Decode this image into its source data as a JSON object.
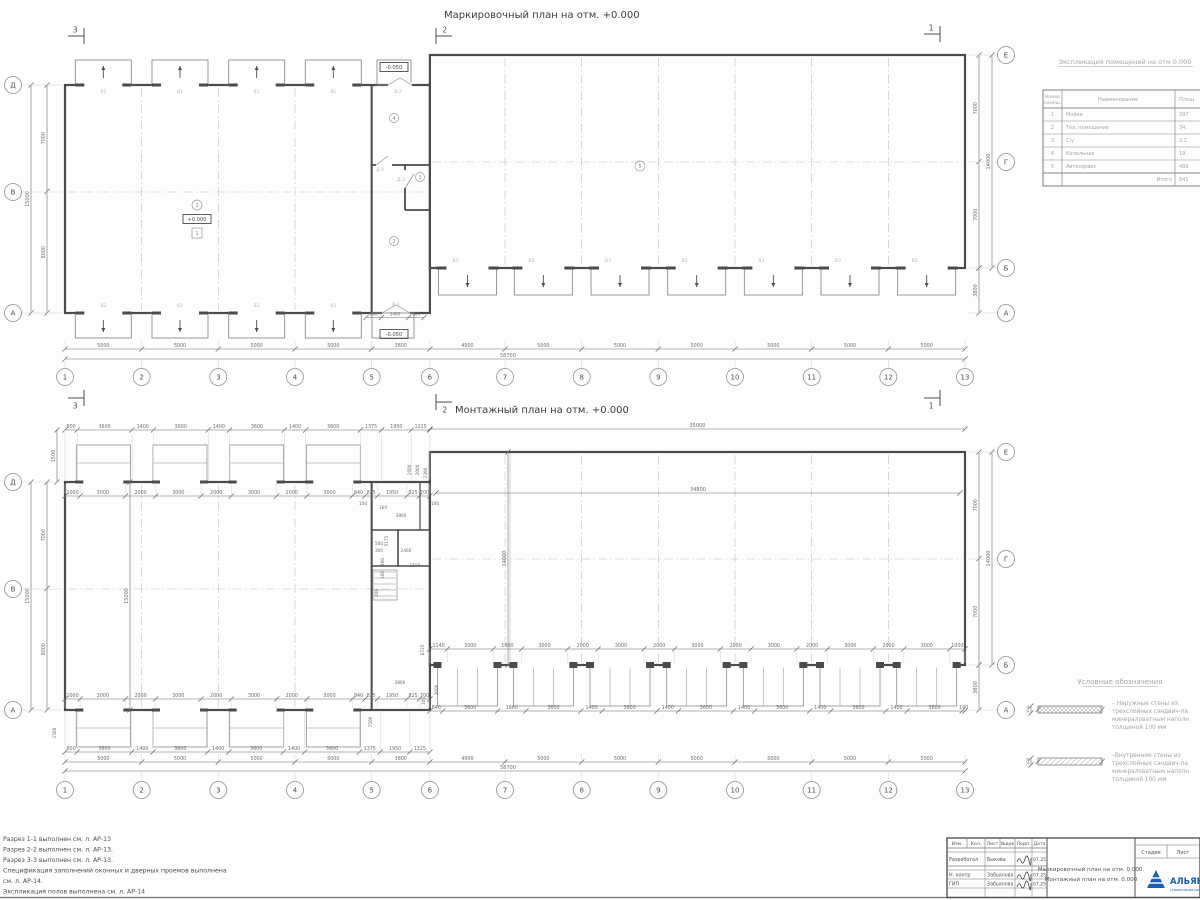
{
  "colors": {
    "logo_blue": "#1761b0",
    "line": "#8f8f8f",
    "wall": "#4b4b4b",
    "dim_text": "#6f6f6f",
    "light_label": "#b9b9b9"
  },
  "plan1": {
    "title": "Маркировочный план на отм. +0.000",
    "section_marks": {
      "left": "3",
      "mid": "2",
      "right": "1"
    },
    "bottom_chain": [
      5000,
      5000,
      5000,
      5000,
      3800,
      4900,
      5000,
      5000,
      5000,
      5000,
      5000,
      5000
    ],
    "bottom_total": "58700",
    "axis_numbers": [
      "1",
      "2",
      "3",
      "4",
      "5",
      "6",
      "7",
      "8",
      "9",
      "10",
      "11",
      "12",
      "13"
    ],
    "left_dims": [
      7000,
      8000
    ],
    "left_total": "15000",
    "left_axis_letters": [
      "Д",
      "В",
      "А"
    ],
    "right_dims": [
      7000,
      7000
    ],
    "right_total": "14000",
    "right_extra": "3800",
    "right_axis_letters": [
      "Е",
      "Г",
      "Б",
      "А"
    ],
    "openings": {
      "top_label": "В1",
      "bottom_left_label": "В2",
      "bottom_right_label": "В3",
      "mid_top": "В-2",
      "mid_bottom": "В-1",
      "door1": "Д-4",
      "door2": "Д-3"
    },
    "rooms": {
      "hall_left": "1",
      "mid_bottom": "2",
      "mid_small": "3",
      "mid_top": "4",
      "hall_right": "5"
    },
    "elevation_main": "+0.000",
    "elevation_low": "-0.050",
    "mid_bottom_dims": [
      800,
      1400,
      800
    ]
  },
  "plan2": {
    "title": "Монтажный план на отм. +0.000",
    "bottom_chain": [
      5000,
      5000,
      5000,
      5000,
      3800,
      4900,
      5000,
      5000,
      5000,
      5000,
      5000,
      5000
    ],
    "bottom_total": "58700",
    "axis_numbers": [
      "1",
      "2",
      "3",
      "4",
      "5",
      "6",
      "7",
      "8",
      "9",
      "10",
      "11",
      "12",
      "13"
    ],
    "left_dims": [
      7000,
      8000
    ],
    "left_total": "15000",
    "left_axis_letters": [
      "Д",
      "В",
      "А"
    ],
    "right_dims": [
      7000,
      7000
    ],
    "right_total": "14000",
    "right_extra": "3800",
    "right_axis_letters": [
      "Е",
      "Г",
      "Б",
      "А"
    ],
    "top_chain_outer": [
      800,
      3600,
      1400,
      3600,
      1400,
      3600,
      1400,
      3600,
      1375,
      1950,
      1225
    ],
    "top_chain_inner": [
      1000,
      3000,
      2000,
      3000,
      2000,
      3000,
      2000,
      3000,
      840,
      825,
      1950,
      825,
      700
    ],
    "bottom_chain_inner": [
      1000,
      3000,
      2000,
      3000,
      2000,
      3000,
      2000,
      3000,
      840,
      825,
      1950,
      825,
      700
    ],
    "bottom_chain_outer": [
      800,
      3600,
      1400,
      3600,
      1400,
      3600,
      1400,
      3600,
      1375,
      1950,
      1325
    ],
    "rb_chain_upper": [
      1140,
      3000,
      1860,
      3000,
      2000,
      3000,
      2000,
      3000,
      2000,
      3000,
      2000,
      3000,
      2000,
      3000,
      1000
    ],
    "rb_chain_lower": [
      840,
      3600,
      1860,
      3600,
      1400,
      3600,
      1400,
      3600,
      1400,
      3600,
      1400,
      3600,
      1400,
      3600,
      190
    ],
    "right_total_top": "35000",
    "right_inner_total": "34800",
    "vert_right_hall": "14000",
    "vert_left_hall": "15000",
    "vert_top_left": "1500",
    "free_dims": [
      {
        "t": "100",
        "x": 363,
        "y": 505,
        "r": 0
      },
      {
        "t": "160",
        "x": 383,
        "y": 509,
        "r": 0
      },
      {
        "t": "3860",
        "x": 401,
        "y": 517,
        "r": 0
      },
      {
        "t": "100",
        "x": 435,
        "y": 505,
        "r": 0
      },
      {
        "t": "5175",
        "x": 388,
        "y": 541,
        "r": -90
      },
      {
        "t": "1600",
        "x": 411,
        "y": 470,
        "r": -90
      },
      {
        "t": "2000",
        "x": 419,
        "y": 470,
        "r": -90
      },
      {
        "t": "2390",
        "x": 427,
        "y": 473,
        "r": -90
      },
      {
        "t": "500",
        "x": 379,
        "y": 545,
        "r": 0
      },
      {
        "t": "300",
        "x": 379,
        "y": 552,
        "r": 0
      },
      {
        "t": "2460",
        "x": 406,
        "y": 552,
        "r": 0
      },
      {
        "t": "1500",
        "x": 415,
        "y": 567,
        "r": 0
      },
      {
        "t": "400",
        "x": 384,
        "y": 562,
        "r": -90
      },
      {
        "t": "100",
        "x": 384,
        "y": 575,
        "r": -90
      },
      {
        "t": "200",
        "x": 378,
        "y": 593,
        "r": -90
      },
      {
        "t": "8725",
        "x": 424,
        "y": 650,
        "r": -90
      },
      {
        "t": "3860",
        "x": 400,
        "y": 684,
        "r": 0
      },
      {
        "t": "7500",
        "x": 372,
        "y": 722,
        "r": -90
      },
      {
        "t": "3000",
        "x": 438,
        "y": 690,
        "r": -90
      },
      {
        "t": "100",
        "x": 425,
        "y": 701,
        "r": -90
      },
      {
        "t": "1500",
        "x": 56,
        "y": 733,
        "r": -90
      }
    ]
  },
  "explication": {
    "title": "Экспликация помещений на отм 0.000",
    "col1_line1": "Номер",
    "col1_line2": "помещ.",
    "col2": "Наименование",
    "col3": "Площ",
    "rows": [
      {
        "num": "1",
        "name": "Мойка",
        "area": "297"
      },
      {
        "num": "2",
        "name": "Тех. помещение",
        "area": "34,"
      },
      {
        "num": "3",
        "name": "С/у",
        "area": "2,2"
      },
      {
        "num": "4",
        "name": "Капельная",
        "area": "19,"
      },
      {
        "num": "5",
        "name": "Автосервис",
        "area": "486"
      }
    ],
    "total_label": "Итого",
    "total_value": "841"
  },
  "legend": {
    "title": "Условные обозначения",
    "i1_dim": "100",
    "i1_l1": "– Наружные стены из",
    "i1_l2": "трехслойных сэндвич-па",
    "i1_l3": "минераловатным наполн",
    "i1_l4": "толщиной 100 мм",
    "i2_dim": "100",
    "i2_l1": "–Внутренние стены из",
    "i2_l2": "трехслойных сэндвич-па",
    "i2_l3": "минераловатным наполн",
    "i2_l4": "толщиной 100 мм"
  },
  "notes": {
    "l1": "Разрез 1-1 выполнен см. л. АР-13",
    "l2": "Разрез 2-2 выполнен см. л. АР-13.",
    "l3": "Разрез 3-3 выполнен см. л. АР-13.",
    "l4": "Спецификация заполнений оконных и дверных проемов выполнена",
    "l5": "см. л. АР-14.",
    "l6": "Экспликация полов выполнена см. л. АР-14"
  },
  "title_block": {
    "cols": [
      "Изм.",
      "Кол.",
      "Лист",
      "№док",
      "Подп.",
      "Дата"
    ],
    "row1_role": "Разработал",
    "row1_name": "Быкова",
    "row1_date": "07.25",
    "row2_role": "Н. контр",
    "row2_name": "Забьялова",
    "row2_date": "07.25",
    "row3_role": "ГИП",
    "row3_name": "Забьялова",
    "row3_date": "07.25",
    "doc_line1": "Маркировочный план на отм. 0.000.",
    "doc_line2": "Монтажный план на отм. 0.000",
    "stage": "Стадия",
    "list": "Лист",
    "logo": "АЛЬЯНС",
    "logo_sub": "строительная компания"
  }
}
